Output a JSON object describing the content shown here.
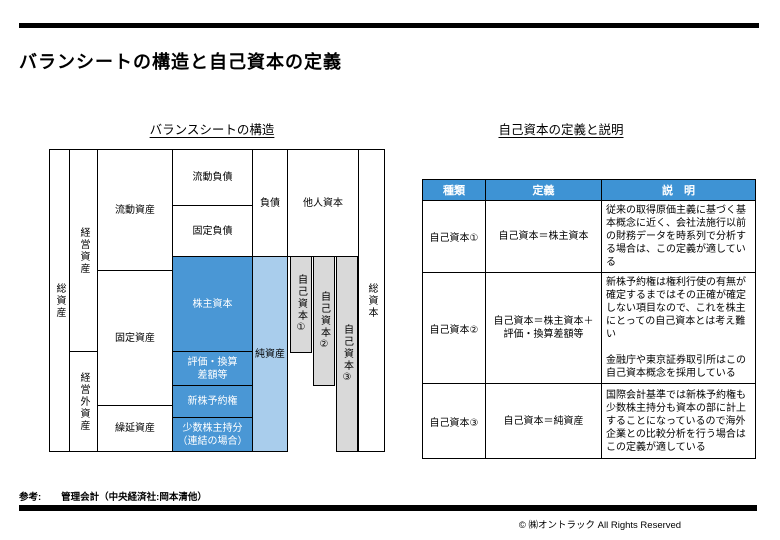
{
  "colors": {
    "accent_blue": "#4a97d5",
    "light_blue": "#a9cdec",
    "bar_gray": "#d9d9d9",
    "header_blue": "#3e93d4"
  },
  "header": {
    "title": "バランシートの構造と自己資本の定義"
  },
  "left_panel": {
    "title": "バランスシートの構造",
    "diagram": {
      "total_assets": "総資産",
      "operating_assets": "経営資産",
      "non_operating_assets": "経営外資産",
      "current_assets": "流動資産",
      "fixed_assets": "固定資産",
      "deferred_assets": "繰延資産",
      "current_liabilities": "流動負債",
      "fixed_liabilities": "固定負債",
      "shareholders_equity": "株主資本",
      "valuation_lines": [
        "評価・換算",
        "差額等"
      ],
      "share_warrants": "新株予約権",
      "minority_lines": [
        "少数株主持分",
        "（連結の場合）"
      ],
      "liabilities": "負債",
      "net_assets": "純資産",
      "other_capital": "他人資本",
      "equity_bar1": "自己資本①",
      "equity_bar2": "自己資本②",
      "equity_bar3": "自己資本③",
      "total_capital": "総資本"
    }
  },
  "right_panel": {
    "title": "自己資本の定義と説明",
    "table": {
      "headers": [
        "種類",
        "定義",
        "説　明"
      ],
      "rows": [
        {
          "type": "自己資本①",
          "definition": "自己資本＝株主資本",
          "explanation": "従来の取得原価主義に基づく基本概念に近く、会社法施行以前の財務データを時系列で分析する場合は、この定義が適している"
        },
        {
          "type": "自己資本②",
          "definition_lines": [
            "自己資本＝株主資本＋",
            "評価・換算差額等"
          ],
          "explanation_paragraphs": [
            "新株予約権は権利行使の有無が確定するまではその正確が確定しない項目なので、これを株主にとっての自己資本とは考え難い",
            "金融庁や東京証券取引所はこの自己資本概念を採用している"
          ]
        },
        {
          "type": "自己資本③",
          "definition": "自己資本＝純資産",
          "explanation": "国際会計基準では新株予約権も少数株主持分も資本の部に計上することになっているので海外企業との比較分析を行う場合はこの定義が適している"
        }
      ]
    }
  },
  "footer": {
    "ref_label": "参考:",
    "ref_text": "管理会計（中央経済社:岡本清他）",
    "copyright": "©  ㈱オントラック  All Rights Reserved"
  }
}
